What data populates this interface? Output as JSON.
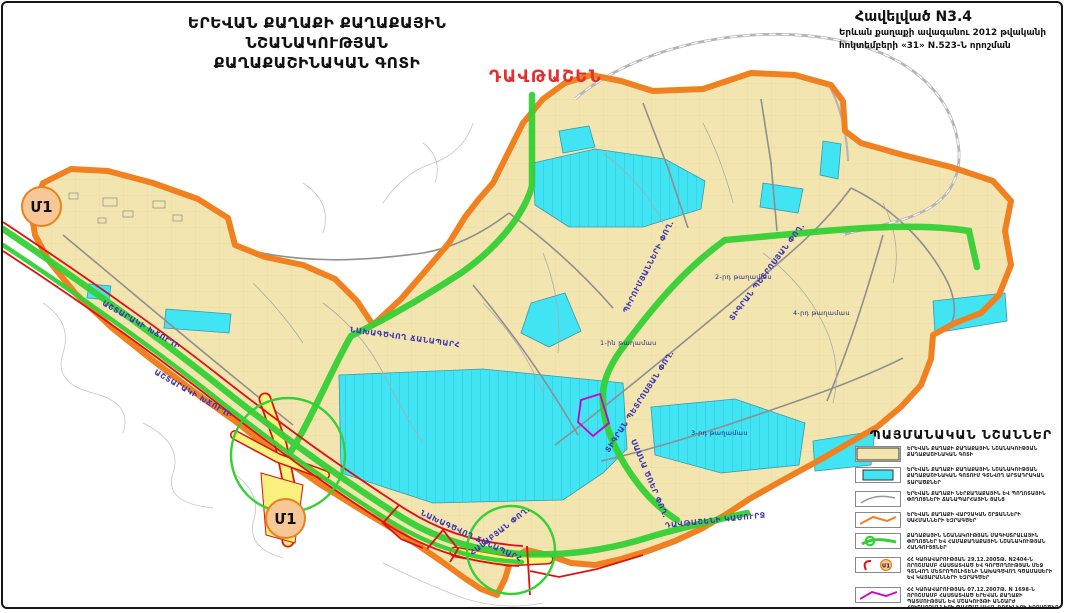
{
  "title": {
    "line1": "ԵՐԵՎԱՆ ՔԱՂԱՔԻ ՔԱՂԱՔԱՅԻՆ ՆՇԱՆԱԿՈՒԹՅԱՆ",
    "line2": "ՔԱՂԱՔԱՇԻՆԱԿԱՆ ԳՈՏԻ"
  },
  "annex": {
    "line1": "Հավելված N3.4",
    "line2": "Երևան քաղաքի ավագանու 2012 թվականի",
    "line3": "հոկտեմբերի «31» N.523-Ն որոշման"
  },
  "map": {
    "district_label": "ԴԱՎԹԱՇԵՆ",
    "metro": {
      "label": "Մ1"
    },
    "streets": [
      {
        "text": "ԱՇՏԱՐԱԿԻ ԽՃՈՒՂԻ"
      },
      {
        "text": "ԱՇՏԱՐԱԿԻ ԽՃՈՒՂԻ"
      },
      {
        "text": "ՆԱԽԱԳԾՎՈՂ ՃԱՆԱՊԱՐՀ"
      },
      {
        "text": "ՆԱԽԱԳԾՎՈՂ ՃԱՆԱՊԱՐՀ"
      },
      {
        "text": "ՊԻՐՈՒՄՅԱՆՆԵՐԻ ՓՈՂ."
      },
      {
        "text": "ՏԻԳՐԱՆ ՊԵՏՐՈՍՅԱՆ ՓՈՂ."
      },
      {
        "text": "ՏԻԳՐԱՆ ՊԵՏՐՈՍՅԱՆ ՓՈՂ."
      },
      {
        "text": "ՍԱՍՆԱ ԾՌԵՐ ՓՈՂ."
      },
      {
        "text": "ՀԱԼԱԲՅԱՆ ՓՈՂ."
      },
      {
        "text": "ԴԱՎԹԱՇԵՆԻ ԿԱՄՈՒՐՋ"
      }
    ],
    "blocks": [
      {
        "text": "1-ին թաղամաս"
      },
      {
        "text": "2-րդ թաղամաս"
      },
      {
        "text": "3-րդ թաղամաս"
      },
      {
        "text": "4-րդ թաղամաս"
      }
    ]
  },
  "legend": {
    "header": "ՊԱՅՄԱՆԱԿԱՆ ՆՇԱՆՆԵՐ",
    "items": [
      {
        "symbol": "urban-zone-fill",
        "text": "ԵՐԵՎԱՆ ՔԱՂԱՔԻ ՔԱՂԱՔԱՅԻՆ ՆՇԱՆԱԿՈՒԹՅԱՆ ՔԱՂԱՔԱՇԻՆԱԿԱՆ ԳՈՏԻ"
      },
      {
        "symbol": "industrial-areas-fill",
        "text": "ԵՐԵՎԱՆ ՔԱՂԱՔԻ ՔԱՂԱՔԱՅԻՆ ՆՇԱՆԱԿՈՒԹՅԱՆ ՔԱՂԱՔԱՇԻՆԱԿԱՆ ԳՈՏՈՒՄ ԳՏՆՎՈՂ ԱՐՏԱԴՐԱԿԱՆ ՏԱՐԱԾՔՆԵՐ"
      },
      {
        "symbol": "road-network-line",
        "text": "ԵՐԵՎԱՆ ՔԱՂԱՔԻ ՆԵՐՔԱՂԱՔԱՅԻՆ ԵՎ ՊՈՂՈՏԱՅԻՆ ՓՈՂՈՑՆԵՐԻ ՃԱՆԱՊԱՐՀԱՅԻՆ ՑԱՆՑ"
      },
      {
        "symbol": "admin-boundary-line",
        "text": "ԵՐԵՎԱՆ ՔԱՂԱՔԻ ՎԱՐՉԱԿԱՆ ՇՐՋԱՆՆԵՐԻ ՍԱՀՄԱՆՆԵՐԻ ԵԶՐԱԳԾԵՐ"
      },
      {
        "symbol": "main-streets-line",
        "text": "ՔԱՂԱՔԱՅԻՆ ՆՇԱՆԱԿՈՒԹՅԱՆ ՄԱԳԻՍՏՐԱԼԱՅԻՆ ՓՈՂՈՑՆԵՐ ԵՎ ՀԱՄԱՔԱՂԱՔԱՅԻՆ ՆՇԱՆԱԿՈՒԹՅԱՆ ՀԱՆԳՈՒՅՑՆԵՐ"
      },
      {
        "symbol": "metro-line-station",
        "text": "ՀՀ ԿԱՌԱՎԱՐՈՒԹՅԱՆ 29.12.2005Թ. N2404-Ն ՈՐՈՇՄԱՄԲ ՀԱՍՏԱՏՎԱԾ ԵՎ ԳՈՐԾՈՂՈՒԹՅԱՆ ՄԵՋ ԳՏՆՎՈՂ ՄԵՏՐՈՊՈԼԻՏԵՆԻ ՆԱԽԱԳԾՎՈՂ ԳԾԱՄԱՍԵՐԻ ԵՎ ԿԱՅԱՐԱՆՆԵՐԻ ԵԶՐԱԳԾԵՐ"
      },
      {
        "symbol": "heritage-zone-line",
        "text": "ՀՀ ԿԱՌԱՎԱՐՈՒԹՅԱՆ 07.12.2007Թ. N 1698-Ն ՈՐՈՇՄԱՄԲ ՀԱՍՏԱՏՎԱԾ ԵՐԵՎԱՆ ՔԱՂԱՔԻ ՊԱՏՄՈՒԹՅԱՆ ԵՎ ՄՇԱԿՈՒՅԹԻ ԱՆՇԱՐԺ ՀՈՒՇԱՐՁԱՆՆԵՐԻ ՊԱՀՊԱՆԱԿԱՆ ԳՈՏԻՆԵՐԻ ԵԶՐԱԳԾԵՐ"
      }
    ]
  },
  "colors": {
    "urban_zone": "#F3E5AF",
    "industrial": "#40E4F2",
    "boundary": "#F08020",
    "main_street": "#35D035",
    "metro_line": "#E01010",
    "heritage": "#CC00CC",
    "street_label": "#3C35B2",
    "district_label": "#E23030"
  }
}
